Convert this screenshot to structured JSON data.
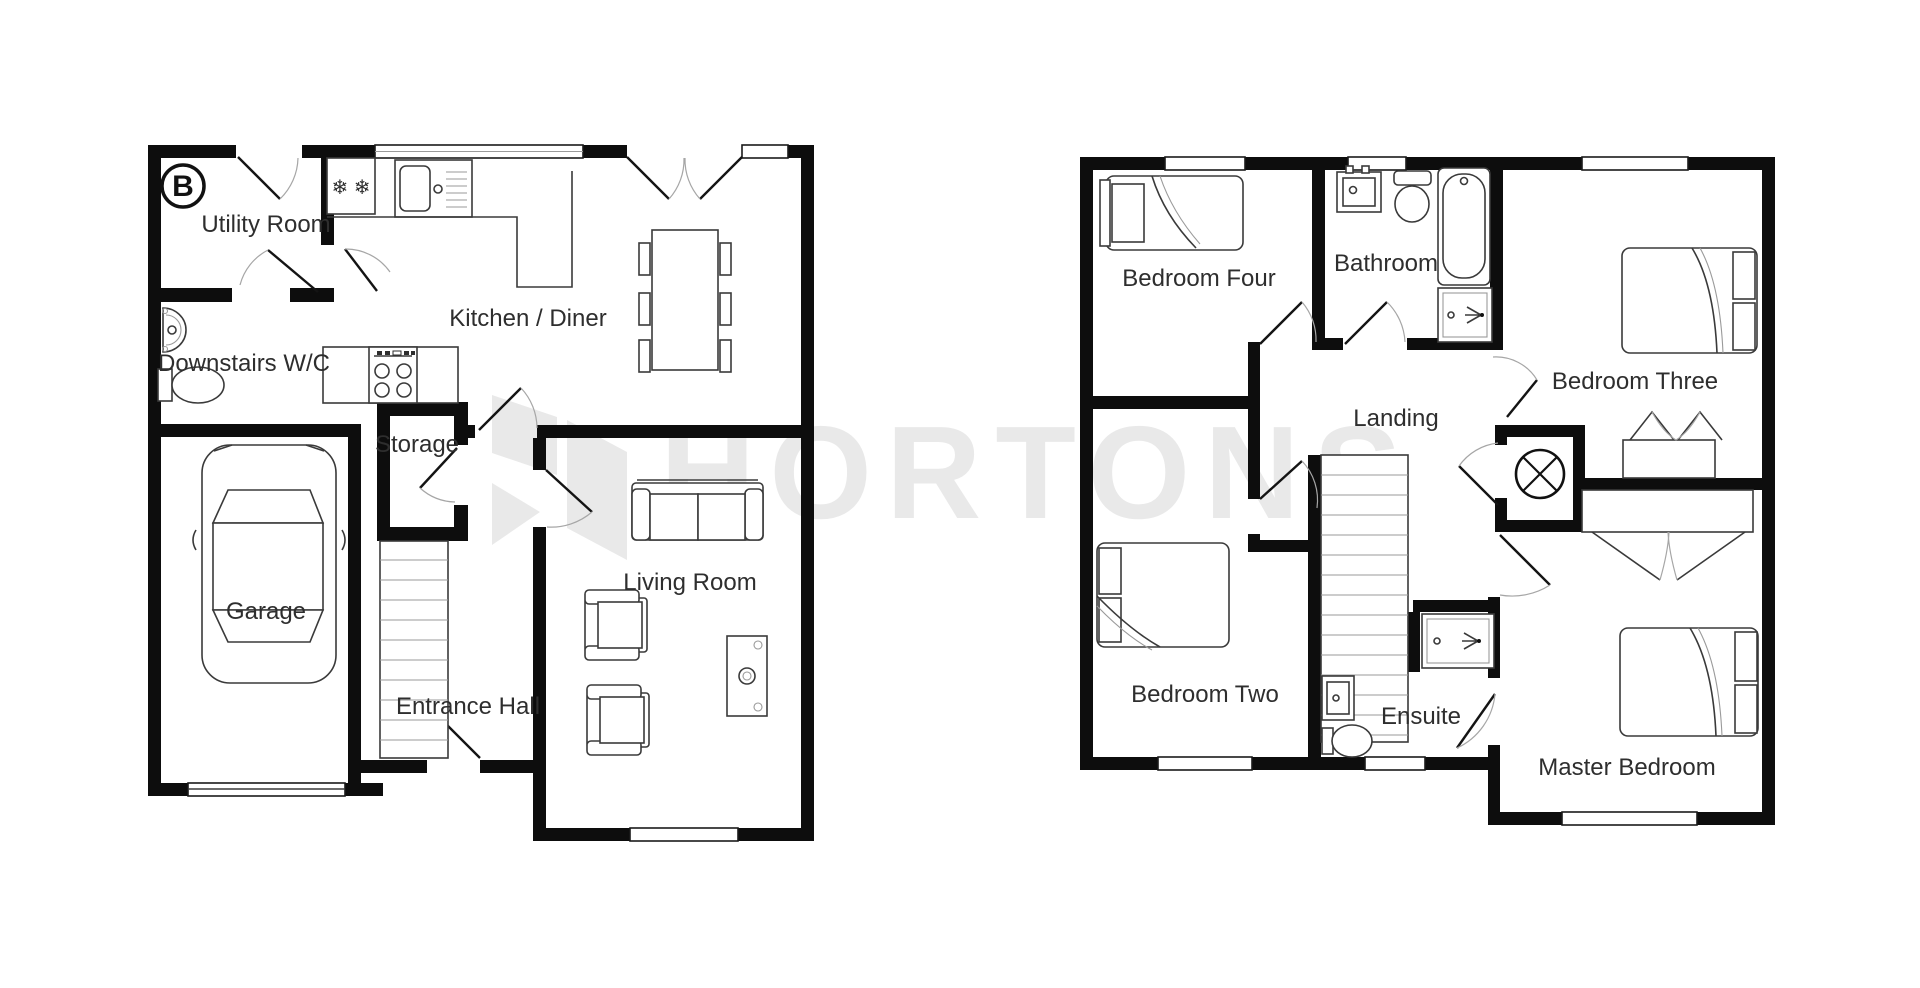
{
  "watermark": {
    "brand": "HORTONS",
    "color": "#e9e9e9"
  },
  "compass": {
    "label": "B"
  },
  "icons": {
    "freezer": "❄ ❄"
  },
  "ground_floor": {
    "rooms": {
      "utility": "Utility Room",
      "wc": "Downstairs W/C",
      "kitchen": "Kitchen / Diner",
      "storage": "Storage",
      "garage": "Garage",
      "hall": "Entrance Hall",
      "living": "Living Room"
    }
  },
  "first_floor": {
    "rooms": {
      "bedroom4": "Bedroom Four",
      "bathroom": "Bathroom",
      "bedroom3": "Bedroom Three",
      "landing": "Landing",
      "bedroom2": "Bedroom Two",
      "ensuite": "Ensuite",
      "master": "Master Bedroom"
    }
  }
}
